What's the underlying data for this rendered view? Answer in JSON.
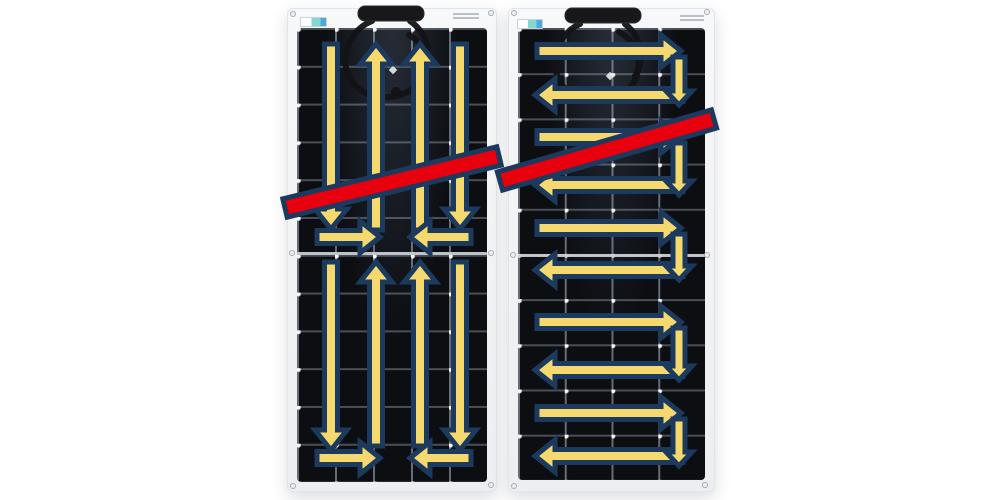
{
  "image": {
    "width": 1000,
    "height": 500,
    "background": "#ffffff",
    "subject": "two flexible solar panels with current-flow arrows and diagonal no-bend prohibition bars",
    "visible_text": ""
  },
  "colors": {
    "arrow_fill": "#F5D96E",
    "arrow_stroke": "#1B3A5E",
    "bar_fill": "#E8000E",
    "bar_stroke": "#1B3A5E",
    "panel_frame": "#F3F4F6",
    "cell_black": "#0C0E12",
    "grid_line": "#AFB9C6",
    "intersection_dot": "#FFFFFF",
    "junction_box": "#18181A",
    "cable": "#131316"
  },
  "panels": [
    {
      "name": "left-panel",
      "flow_pattern": "vertical-serpentine",
      "frame": {
        "x": 287,
        "y": 8,
        "w": 210,
        "h": 484
      },
      "cells_inset": {
        "left": 10,
        "top": 20,
        "right": 10,
        "bottom": 10
      },
      "grid": {
        "x": 38,
        "y": 37.8
      },
      "seam_abs_y": 253,
      "junction_box": {
        "x": 358,
        "y": 6,
        "w": 66,
        "h": 15
      },
      "cables": [
        "M372,21 C344,32 336,70 358,88 C376,103 408,99 420,81 C431,65 427,45 409,35",
        "M410,21 C428,33 434,58 421,76"
      ],
      "cable_blobs": [
        [
          378,
          89
        ],
        [
          396,
          92
        ]
      ],
      "cable_clip_diamond": [
        393,
        70
      ],
      "stickers": {
        "teal": {
          "x": 300,
          "y": 17,
          "w": 25,
          "h": 8
        },
        "text": {
          "x": 453,
          "y": 13,
          "w": 26,
          "h": 8
        }
      },
      "screws": [
        [
          293,
          14
        ],
        [
          491,
          13
        ],
        [
          293,
          486
        ],
        [
          491,
          485
        ],
        [
          292,
          253
        ],
        [
          491,
          253
        ]
      ],
      "arrows": [
        {
          "x1": 331,
          "y1": 44,
          "x2": 331,
          "y2": 229
        },
        {
          "x1": 376,
          "y1": 230,
          "x2": 376,
          "y2": 44
        },
        {
          "x1": 420,
          "y1": 230,
          "x2": 420,
          "y2": 44
        },
        {
          "x1": 460,
          "y1": 44,
          "x2": 460,
          "y2": 229
        },
        {
          "x1": 317,
          "y1": 237,
          "x2": 380,
          "y2": 237
        },
        {
          "x1": 471,
          "y1": 237,
          "x2": 410,
          "y2": 237
        },
        {
          "x1": 331,
          "y1": 262,
          "x2": 331,
          "y2": 450
        },
        {
          "x1": 376,
          "y1": 446,
          "x2": 376,
          "y2": 262
        },
        {
          "x1": 420,
          "y1": 446,
          "x2": 420,
          "y2": 262
        },
        {
          "x1": 460,
          "y1": 262,
          "x2": 460,
          "y2": 450
        },
        {
          "x1": 317,
          "y1": 458,
          "x2": 380,
          "y2": 458
        },
        {
          "x1": 471,
          "y1": 458,
          "x2": 410,
          "y2": 458
        }
      ]
    },
    {
      "name": "right-panel",
      "flow_pattern": "horizontal-serpentine",
      "frame": {
        "x": 508,
        "y": 8,
        "w": 207,
        "h": 484
      },
      "cells_inset": {
        "left": 10,
        "top": 20,
        "right": 10,
        "bottom": 12
      },
      "grid": {
        "x": 46.75,
        "y": 45.2
      },
      "seam_abs_y": 255,
      "junction_box": {
        "x": 565,
        "y": 8,
        "w": 76,
        "h": 15
      },
      "cables": [
        "M580,24 C552,36 546,76 570,93 C592,108 626,100 635,80 C643,61 637,41 619,32",
        "M625,24 C641,36 646,60 635,76"
      ],
      "cable_blobs": [
        [
          598,
          96
        ],
        [
          618,
          93
        ]
      ],
      "cable_clip_diamond": [
        610,
        76
      ],
      "stickers": {
        "teal": {
          "x": 517,
          "y": 19,
          "w": 24,
          "h": 8
        },
        "text": {
          "x": 680,
          "y": 15,
          "w": 24,
          "h": 8
        }
      },
      "screws": [
        [
          514,
          13
        ],
        [
          707,
          12
        ],
        [
          514,
          486
        ],
        [
          705,
          485
        ],
        [
          513,
          255
        ],
        [
          707,
          255
        ]
      ],
      "arrows": [
        {
          "x1": 537,
          "y1": 51,
          "x2": 681,
          "y2": 51
        },
        {
          "x1": 683,
          "y1": 95,
          "x2": 535,
          "y2": 95
        },
        {
          "x1": 679,
          "y1": 57,
          "x2": 679,
          "y2": 105,
          "kind": "connector"
        },
        {
          "x1": 537,
          "y1": 137,
          "x2": 681,
          "y2": 137
        },
        {
          "x1": 683,
          "y1": 185,
          "x2": 535,
          "y2": 185
        },
        {
          "x1": 679,
          "y1": 143,
          "x2": 679,
          "y2": 195,
          "kind": "connector"
        },
        {
          "x1": 537,
          "y1": 228,
          "x2": 681,
          "y2": 228
        },
        {
          "x1": 683,
          "y1": 270,
          "x2": 535,
          "y2": 270
        },
        {
          "x1": 679,
          "y1": 234,
          "x2": 679,
          "y2": 280,
          "kind": "connector"
        },
        {
          "x1": 537,
          "y1": 322,
          "x2": 681,
          "y2": 322
        },
        {
          "x1": 683,
          "y1": 370,
          "x2": 535,
          "y2": 370
        },
        {
          "x1": 679,
          "y1": 328,
          "x2": 679,
          "y2": 380,
          "kind": "connector"
        },
        {
          "x1": 537,
          "y1": 413,
          "x2": 681,
          "y2": 413
        },
        {
          "x1": 683,
          "y1": 456,
          "x2": 535,
          "y2": 456
        },
        {
          "x1": 679,
          "y1": 419,
          "x2": 679,
          "y2": 466,
          "kind": "connector"
        }
      ]
    }
  ],
  "prohibition_bars": [
    {
      "x1": 285,
      "y1": 208,
      "x2": 499,
      "y2": 156
    },
    {
      "x1": 500,
      "y1": 181,
      "x2": 714,
      "y2": 119
    }
  ],
  "arrow_geometry": {
    "main": {
      "shaft_half": 6.5,
      "head_half": 16,
      "head_len": 20,
      "stroke": 5
    },
    "connector": {
      "shaft_half": 6,
      "head_half": 13,
      "head_len": 14,
      "stroke": 5
    },
    "bar_half": 9.5
  }
}
